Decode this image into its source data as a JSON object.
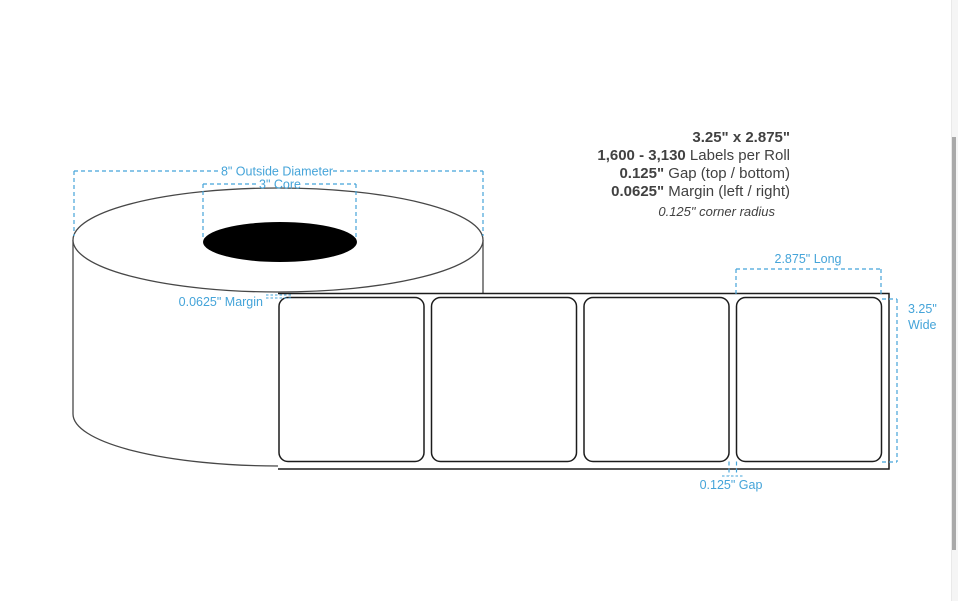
{
  "page": {
    "background": "#ffffff",
    "description": "Label roll dimension diagram"
  },
  "colors": {
    "dimension_accent": "#45a4d9",
    "roll_outline": "#474747",
    "label_outline": "#1c1c1c",
    "core_fill": "#000000",
    "spec_text": "#414141",
    "scrollbar_thumb": "#a9a9a9",
    "scrollbar_track": "#f5f5f5"
  },
  "specs": {
    "size": "3.25\" x 2.875\"",
    "count_value": "1,600 - 3,130",
    "count_label": " Labels per Roll",
    "gap_value": "0.125\"",
    "gap_label": " Gap (top / bottom)",
    "margin_value": "0.0625\"",
    "margin_label": " Margin (left / right)",
    "corner_radius": "0.125\" corner radius"
  },
  "dims": {
    "outside_diameter": "8\" Outside Diameter",
    "core": "3\" Core",
    "margin": "0.0625\" Margin",
    "long": "2.875\" Long",
    "wide_line1": "3.25\"",
    "wide_line2": "Wide",
    "gap": "0.125\" Gap"
  },
  "diagram": {
    "label_count": 4
  }
}
